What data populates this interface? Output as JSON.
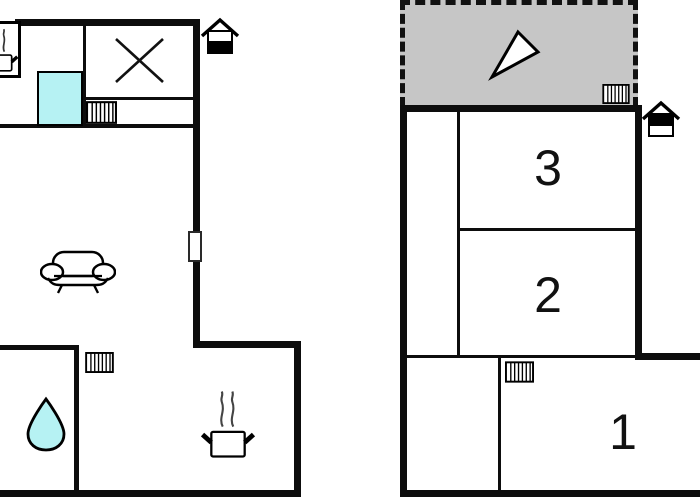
{
  "page": {
    "type": "holiday-home-floor-plan",
    "background": "#ffffff"
  },
  "colors": {
    "wall": "#0d0d0d",
    "water_cyan": "#b6f2f3",
    "terrace_gray": "#c6c6c6",
    "icon_outline": "#000000"
  },
  "left_unit": {
    "rooms": {
      "kitchen": {
        "icons": [
          "steaming-pot-icon",
          "cross-hob-icon",
          "water-square",
          "radiator-icon"
        ]
      },
      "living_room": {
        "icons": [
          "sofa-icon"
        ],
        "openings": [
          "door-window-opening"
        ]
      },
      "bathroom": {
        "icons": [
          "water-drop-icon",
          "radiator-icon"
        ]
      },
      "lower_kitchen": {
        "icons": [
          "steaming-pot-icon"
        ]
      }
    },
    "floor_indicator_icon": "house-ground-floor-icon"
  },
  "right_unit": {
    "terrace": {
      "border_style": "dashed",
      "icons": [
        "direction-arrow-icon",
        "radiator-icon"
      ]
    },
    "rooms": [
      {
        "label": "3"
      },
      {
        "label": "2"
      },
      {
        "label": "1",
        "icons": [
          "radiator-icon"
        ]
      }
    ],
    "floor_indicator_icon": "house-upper-floor-icon"
  }
}
